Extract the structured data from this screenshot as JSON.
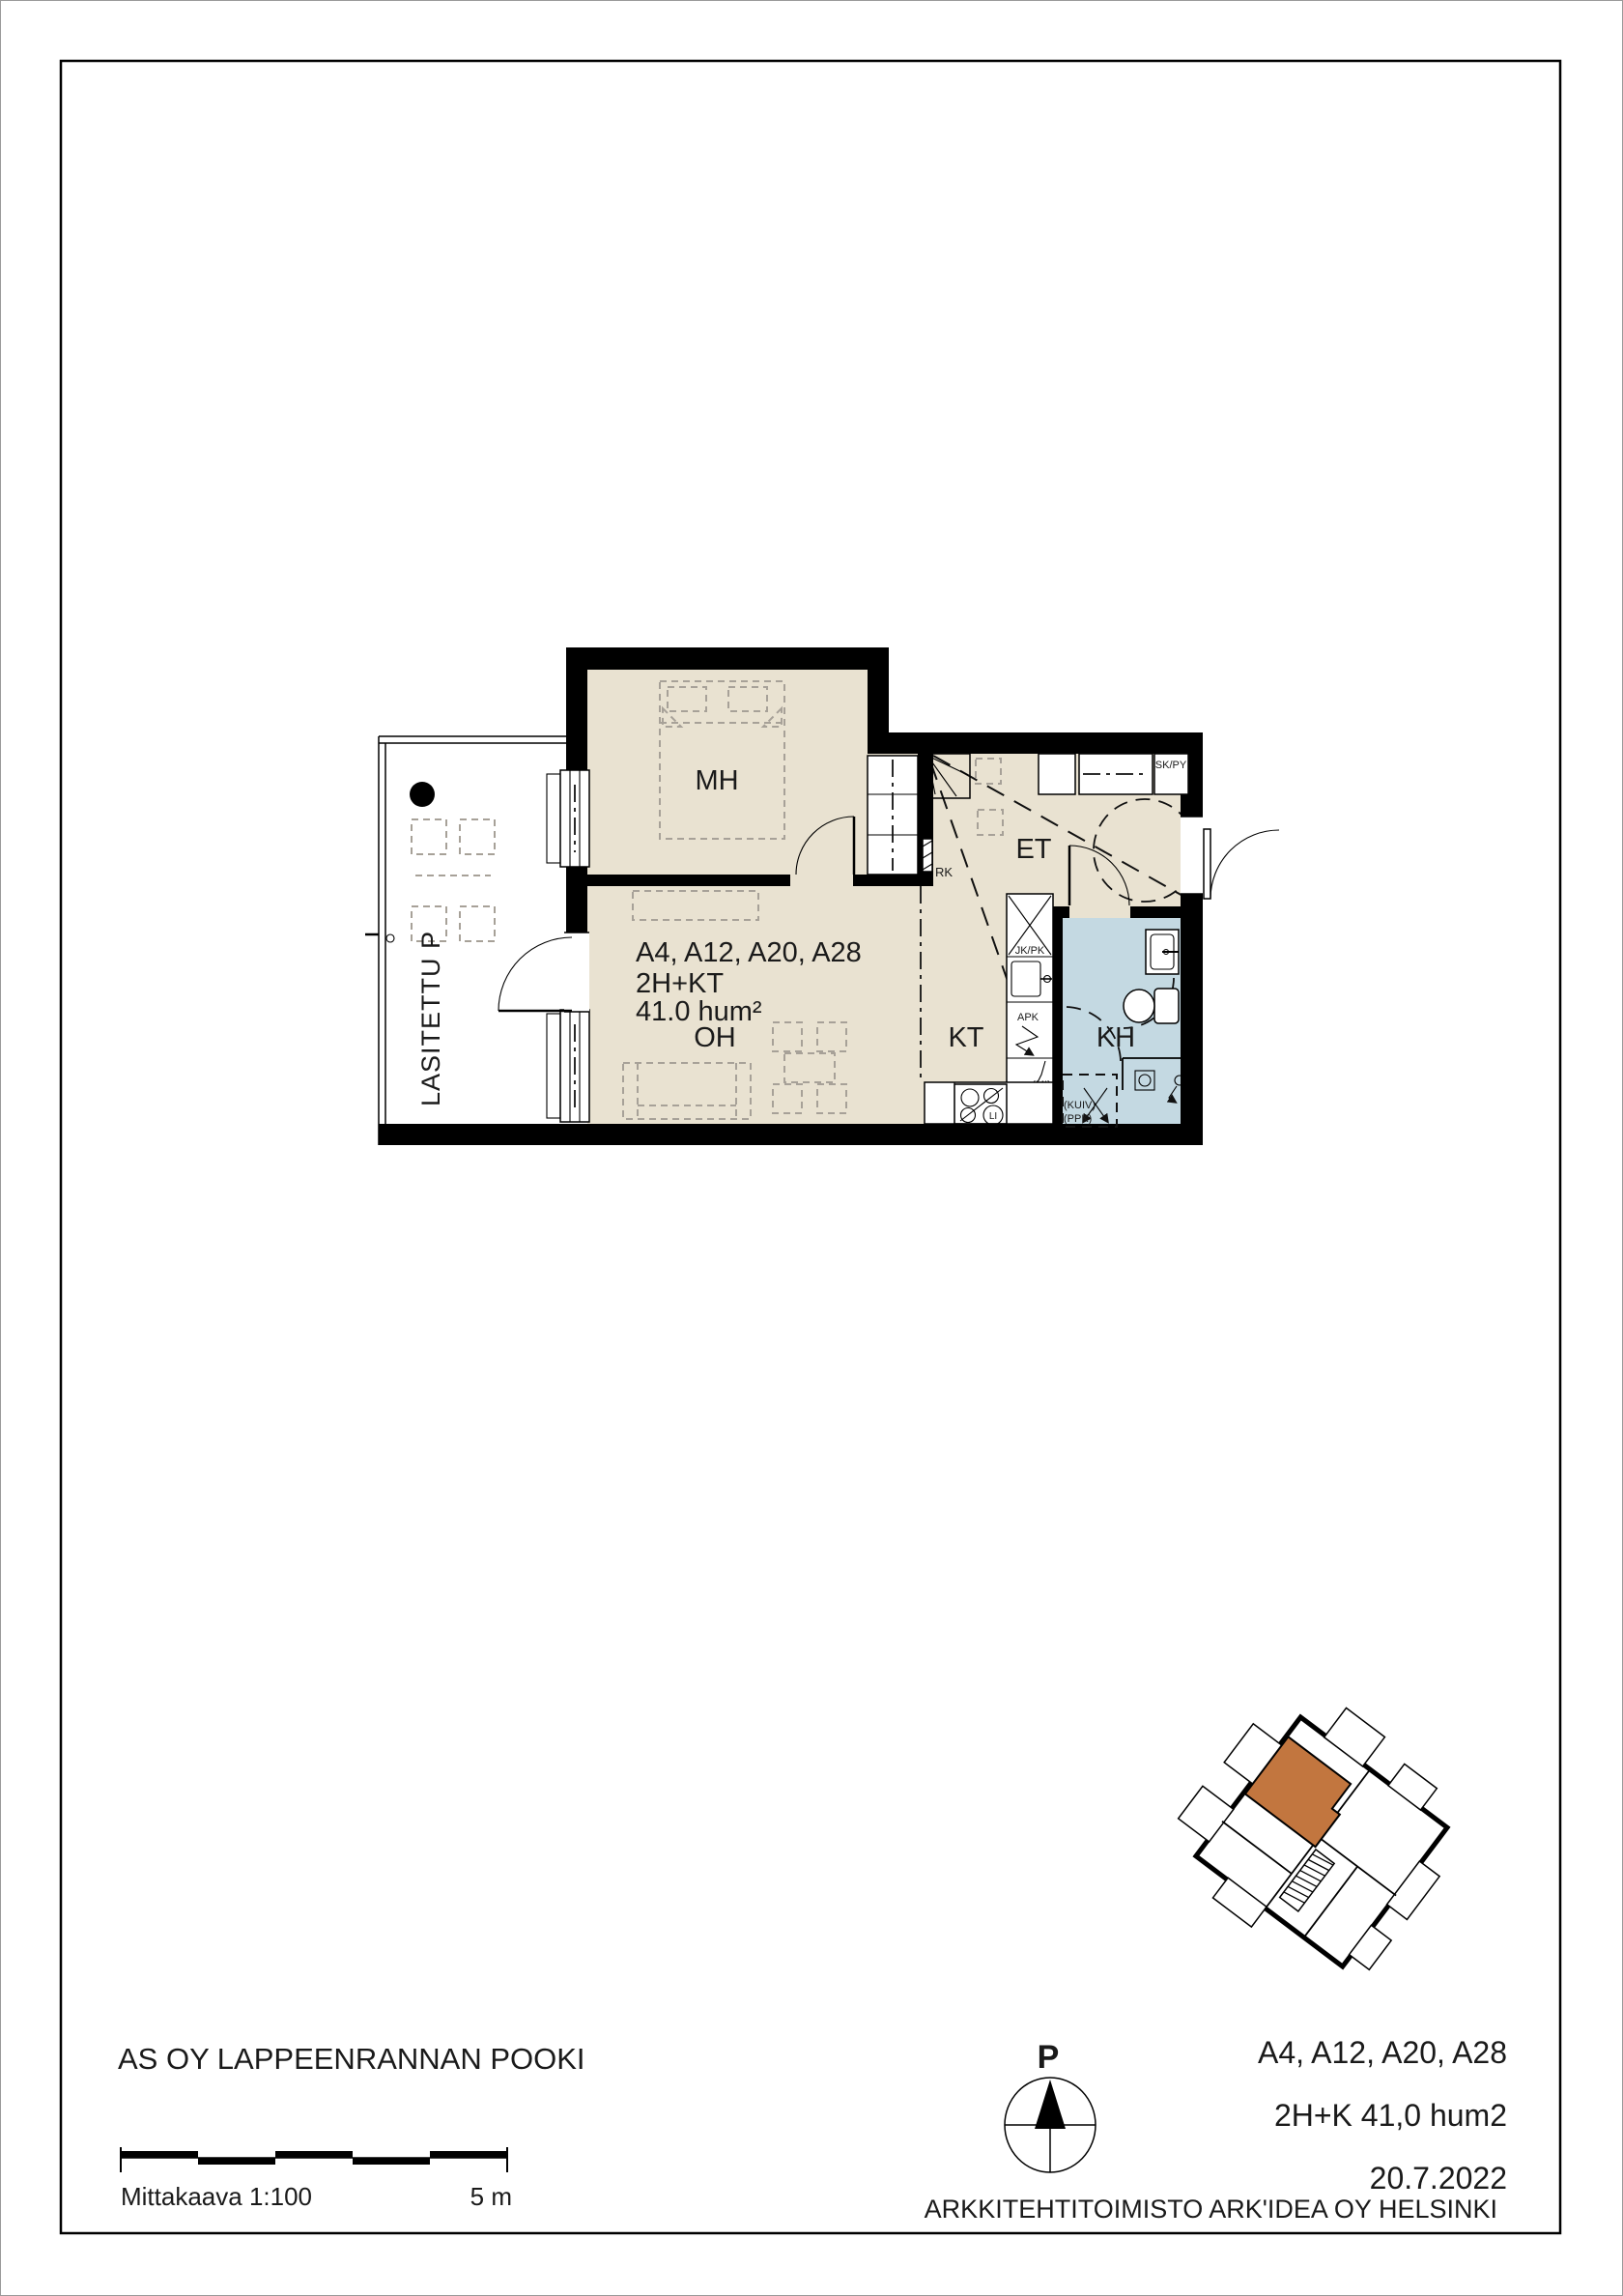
{
  "document": {
    "project_title": "AS OY LAPPEENRANNAN POOKI",
    "scale": {
      "label": "Mittakaava 1:100",
      "length_label": "5 m"
    },
    "north_arrow": {
      "label": "P"
    },
    "title_block": {
      "apartments": "A4, A12, A20, A28",
      "type_area": "2H+K 41,0 hum2",
      "date": "20.7.2022",
      "architect": "ARKKITEHTITOIMISTO ARK'IDEA OY HELSINKI"
    }
  },
  "plan": {
    "apartment_label": {
      "line1": "A4, A12, A20, A28",
      "line2": "2H+KT",
      "line3": "41.0 hum²"
    },
    "rooms": {
      "mh": "MH",
      "oh": "OH",
      "kt": "KT",
      "et": "ET",
      "kh": "KH",
      "balcony": "LASITETTU P"
    },
    "annotations": {
      "skpy": "SK/PY",
      "rk": "RK",
      "jkpk": "JK/PK",
      "apk": "APK",
      "mi": "(MI)",
      "li": "LI",
      "kuiv": "(KUIV)",
      "ppk": "(PPK)"
    }
  },
  "colors": {
    "wall": "#000000",
    "floor_dry": "#e9e2d1",
    "floor_wet": "#c4d9e2",
    "keyplan_highlight": "#c2763f",
    "furniture": "#a7a198"
  }
}
